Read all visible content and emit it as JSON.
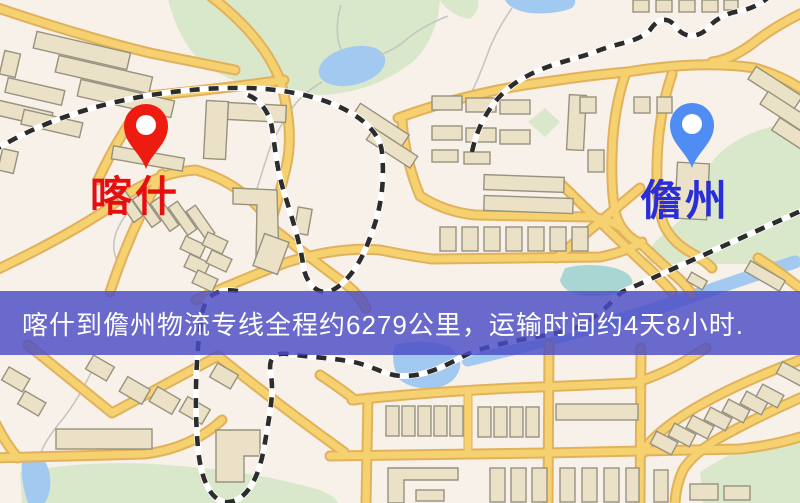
{
  "map": {
    "markers": {
      "origin": {
        "label": "喀什"
      },
      "destination": {
        "label": "儋州"
      }
    },
    "palette": {
      "map-bg": "#f7f1ea",
      "road-core": "#f6d170",
      "road-casing": "#e2b15c",
      "building-fill": "#eae1c6",
      "building-edge": "#97917e",
      "park-green": "#d9e8cb",
      "water-blue": "#a2c9ef",
      "teal-water": "#a8d6d2",
      "rail-dark": "#2c2c2c",
      "rail-light": "#ffffff",
      "stream-gray": "#c6c6c0",
      "origin-pin": "#ee1b10",
      "origin-label": "#e50f0f",
      "dest-pin": "#4f8cf3",
      "dest-label": "#2a2ed6",
      "banner-bg": "rgba(74,76,198,0.82)",
      "banner-text": "#ffffff"
    }
  },
  "banner": {
    "text": "喀什到儋州物流专线全程约6279公里，运输时间约4天8小时."
  }
}
